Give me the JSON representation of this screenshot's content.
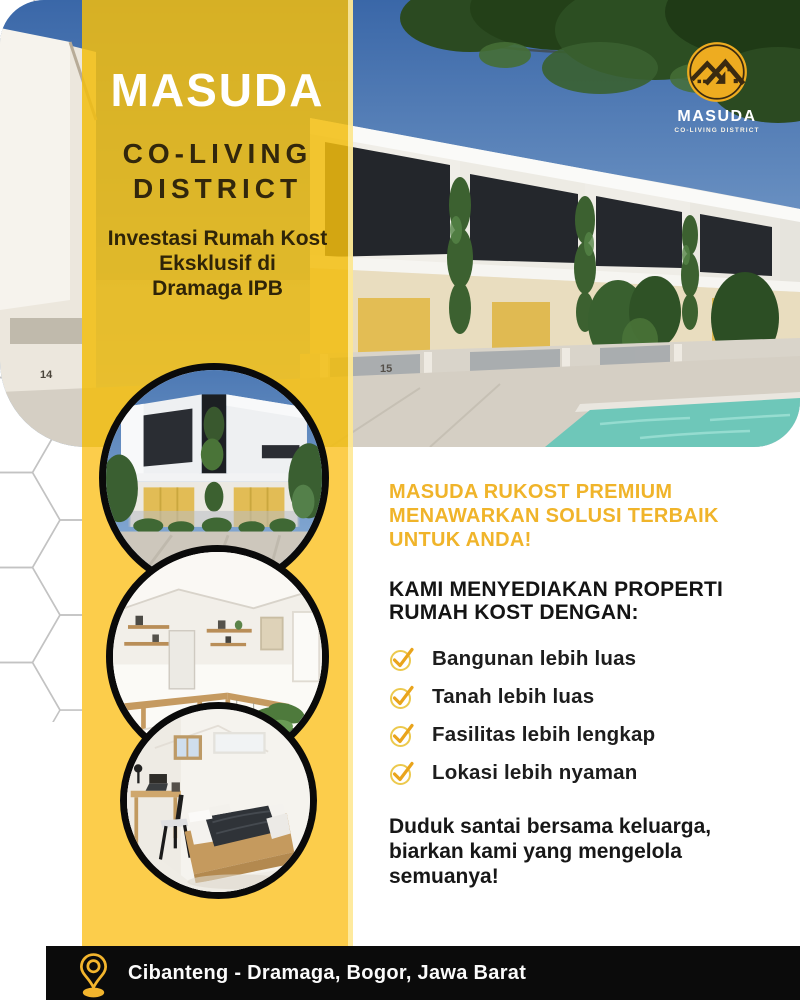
{
  "brand_panel": {
    "title": "MASUDA",
    "subtitle_line1": "CO-LIVING",
    "subtitle_line2": "DISTRICT",
    "tagline_line1": "Investasi Rumah Kost",
    "tagline_line2": "Eksklusif di",
    "tagline_line3": "Dramaga IPB"
  },
  "logo": {
    "name": "MASUDA",
    "tag": "CO-LIVING DISTRICT"
  },
  "hero": {
    "house_number_left": "14",
    "house_number_right": "15"
  },
  "content": {
    "headline_line1": "MASUDA RUKOST PREMIUM",
    "headline_line2": "MENAWARKAN SOLUSI TERBAIK",
    "headline_line3": "UNTUK ANDA!",
    "subheadline_line1": "KAMI MENYEDIAKAN PROPERTI",
    "subheadline_line2": "RUMAH KOST DENGAN:",
    "features": [
      {
        "label": "Bangunan lebih luas"
      },
      {
        "label": "Tanah lebih luas"
      },
      {
        "label": "Fasilitas lebih lengkap"
      },
      {
        "label": "Lokasi lebih nyaman"
      }
    ],
    "closing_line1": "Duduk santai bersama keluarga,",
    "closing_line2": "biarkan kami yang mengelola",
    "closing_line3": "semuanya!"
  },
  "footer": {
    "location": "Cibanteng - Dramaga, Bogor, Jawa Barat"
  },
  "colors": {
    "band_yellow": "#FCCD4B",
    "band_overlay_gold": "#E4B226",
    "heading_gold": "#F0B42A",
    "check_gold": "#E9A41C",
    "check_ring": "#ECC94D",
    "dark_text": "#32270C",
    "footer_black": "#0B0B0B",
    "pin_gold": "#F3B52D",
    "logo_gold": "#EEAC20",
    "logo_dark": "#3B2A10"
  }
}
